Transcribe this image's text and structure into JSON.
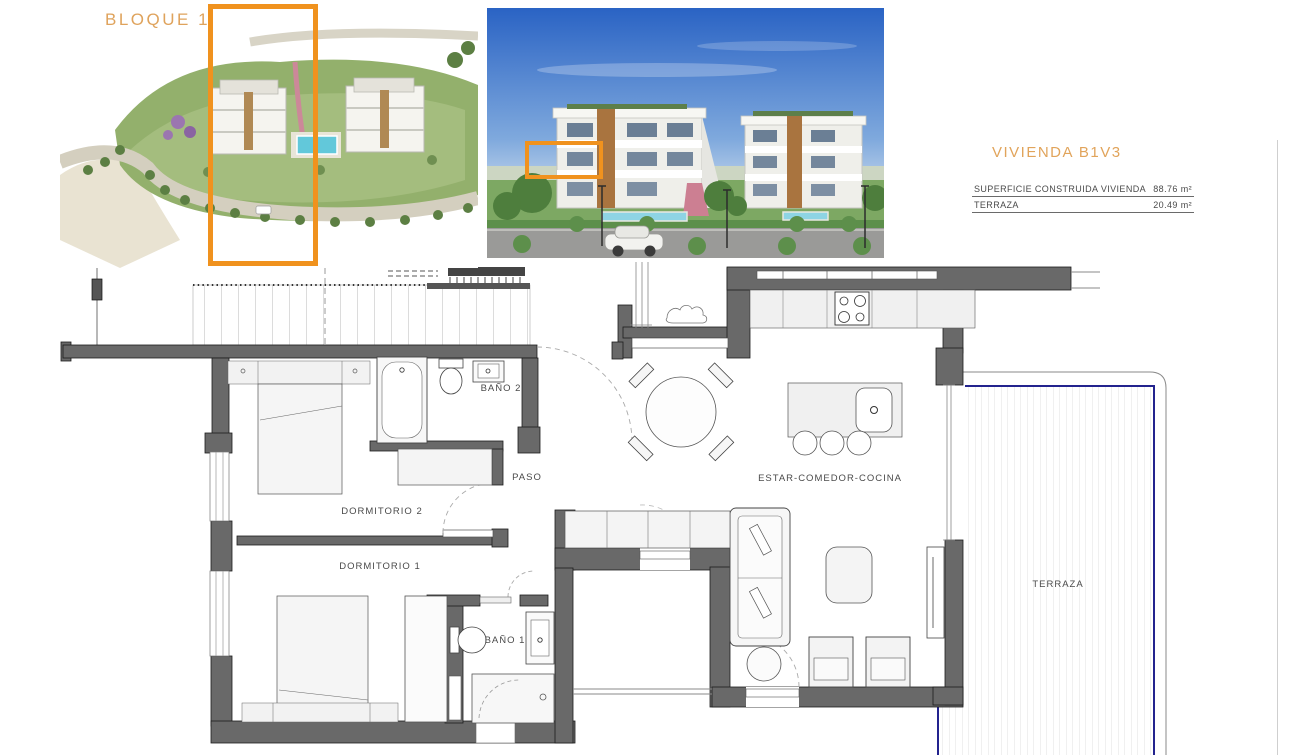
{
  "overview": {
    "block_label": "BLOQUE 1"
  },
  "unit_info": {
    "title": "VIVIENDA B1V3",
    "rows": [
      {
        "label": "SUPERFICIE CONSTRUIDA VIVIENDA",
        "value": "88.76 m²"
      },
      {
        "label": "TERRAZA",
        "value": "20.49 m²"
      }
    ]
  },
  "floor_plan": {
    "rooms": [
      {
        "id": "bano2",
        "label": "BAÑO 2"
      },
      {
        "id": "paso",
        "label": "PASO"
      },
      {
        "id": "dormitorio2",
        "label": "DORMITORIO 2"
      },
      {
        "id": "dormitorio1",
        "label": "DORMITORIO 1"
      },
      {
        "id": "estar",
        "label": "ESTAR-COMEDOR-COCINA"
      },
      {
        "id": "bano1",
        "label": "BAÑO 1"
      },
      {
        "id": "terraza",
        "label": "TERRAZA"
      }
    ]
  },
  "colors": {
    "accent_orange": "#F0921E",
    "label_orange": "#DFA35C",
    "wall_gray": "#696969",
    "navy_edge": "#23238E"
  }
}
